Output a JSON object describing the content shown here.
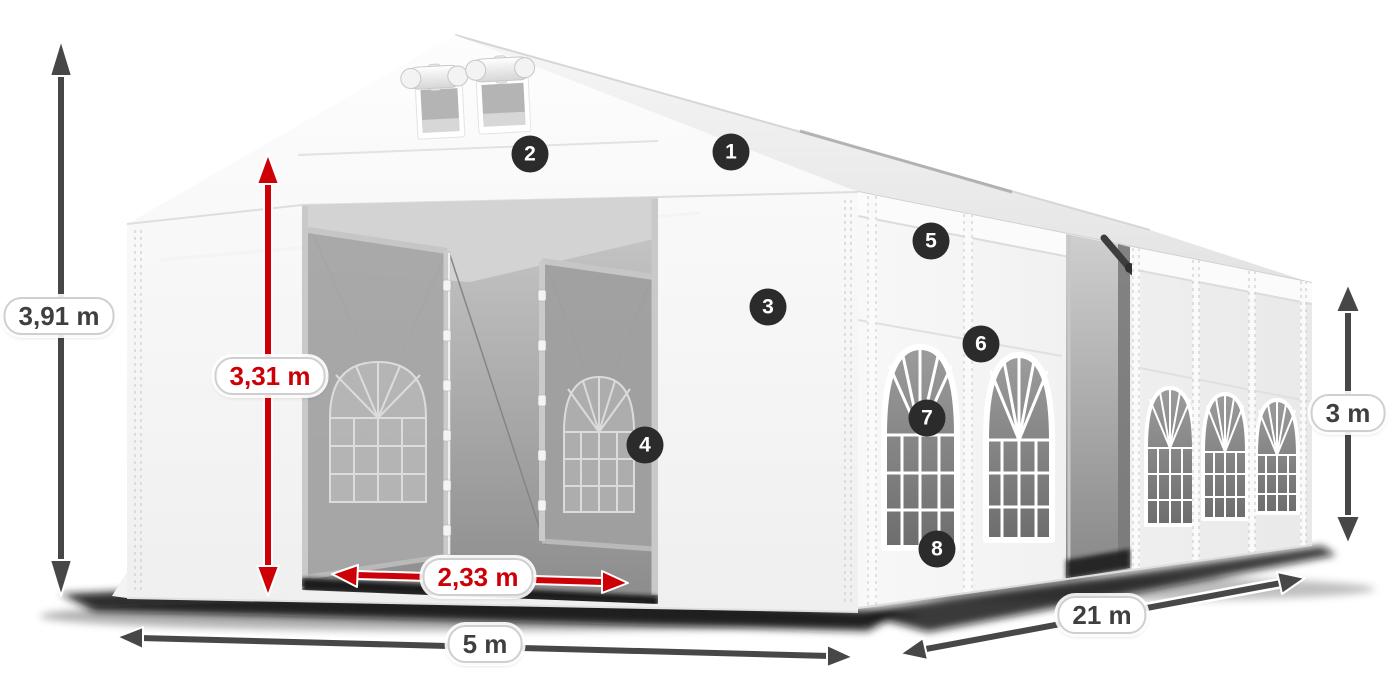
{
  "scene": {
    "description": "White storage/party tent shown in 3D with dimension arrows and numbered part callouts",
    "background_color": "#ffffff"
  },
  "dimensions": {
    "total_height": "3,91 m",
    "entrance_height": "3,31 m",
    "entrance_width": "2,33 m",
    "front_width": "5 m",
    "side_length": "21 m",
    "side_wall_height": "3 m"
  },
  "callouts": [
    "1",
    "2",
    "3",
    "4",
    "5",
    "6",
    "7",
    "8"
  ],
  "colors": {
    "dimension_accent_red": "#cc0006",
    "dimension_gray": "#474747",
    "callout_badge_bg": "#2b2b2b",
    "callout_badge_text": "#ffffff",
    "label_pill_bg": "#ffffff",
    "label_pill_border": "#cfcfcf",
    "tent_white": "#f7f7f7",
    "interior_gray": "#9a9a9a"
  }
}
